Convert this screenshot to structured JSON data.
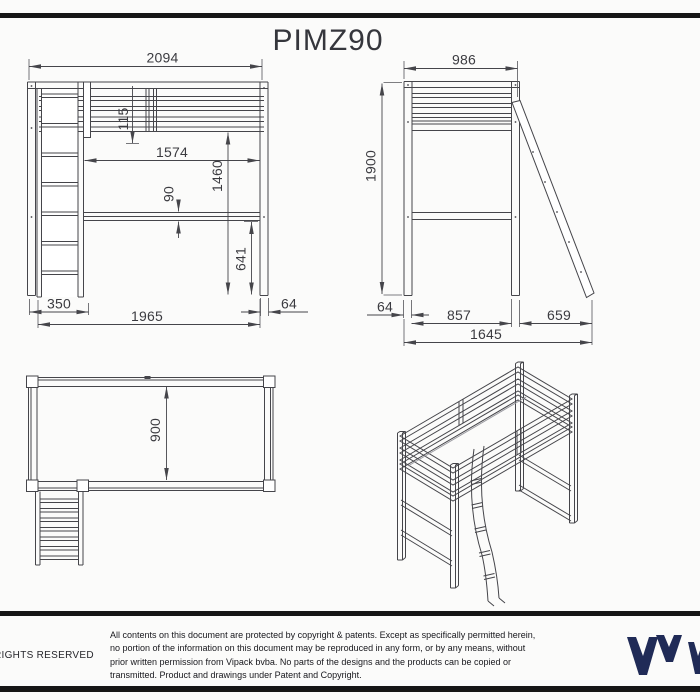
{
  "title": "PIMZ90",
  "drawing": {
    "front_view": {
      "overall_width": "2094",
      "guardrail_height": "115",
      "inner_length": "1574",
      "platform_height": "1460",
      "rail_thickness": "90",
      "under_clearance": "641",
      "ladder_width": "350",
      "base_length": "1965",
      "post_thickness": "64"
    },
    "side_view": {
      "overall_depth": "986",
      "overall_height": "1900",
      "post_thickness": "64",
      "inner_depth": "857",
      "ladder_footprint": "659",
      "total_footprint": "1645"
    },
    "top_view": {
      "bed_width": "900"
    }
  },
  "footer": {
    "rights": "RIGHTS RESERVED",
    "legal_lines": [
      "All contents on this document are protected by copyright & patents. Except as specifically permitted herein,",
      "no portion of the information on this document may be reproduced in any form, or by any means, without",
      "prior written permission from Vipack bvba. No parts of the designs and the products can be copied or",
      "transmitted. Product and drawings under Patent and Copyright."
    ]
  },
  "colors": {
    "line": "#45454a",
    "dim_text": "#3b3b40",
    "bar": "#161616",
    "brand_navy": "#202b57"
  }
}
